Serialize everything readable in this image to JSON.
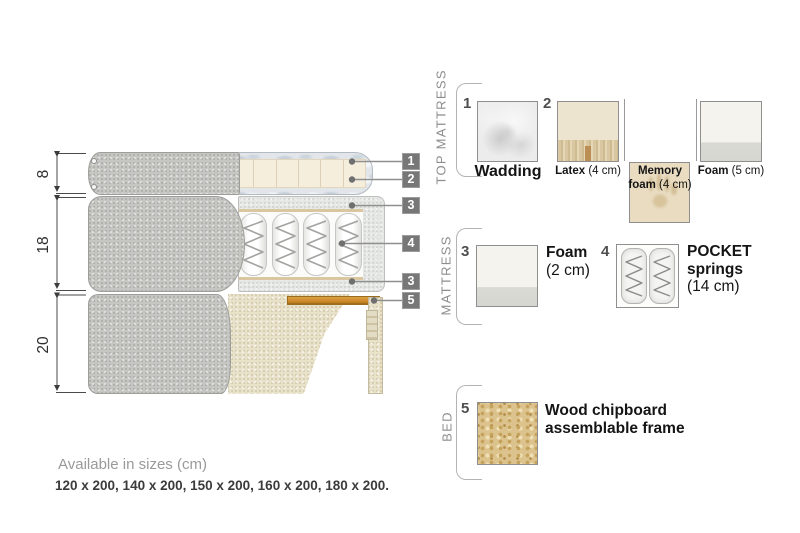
{
  "diagram": {
    "dimension_labels": {
      "top": "8",
      "middle": "18",
      "bottom": "20"
    },
    "callouts": {
      "c1": "1",
      "c2": "2",
      "c3_top": "3",
      "c4": "4",
      "c3_bottom": "3",
      "c5": "5"
    }
  },
  "legend": {
    "top_mattress": {
      "title": "TOP MATTRESS",
      "item1_num": "1",
      "wadding_label": "Wadding",
      "item2_num": "2",
      "latex_name": "Latex",
      "latex_size": " (4 cm)",
      "memory_name_line1": "Memory",
      "memory_name_line2": "foam",
      "memory_size": " (4 cm)",
      "foam_name": "Foam",
      "foam_size": " (5 cm)"
    },
    "mattress": {
      "title": "MATTRESS",
      "item3_num": "3",
      "foam_name": "Foam",
      "foam_size": "(2 cm)",
      "item4_num": "4",
      "springs_name_line1": "POCKET",
      "springs_name_line2": "springs",
      "springs_size": "(14 cm)"
    },
    "bed": {
      "title": "BED",
      "item5_num": "5",
      "frame_line1": "Wood chipboard",
      "frame_line2": "assemblable frame"
    }
  },
  "footer": {
    "sizes_title": "Available in sizes (cm)",
    "sizes_list": "120 x 200, 140 x 200, 150 x 200, 160 x 200, 180 x 200."
  },
  "colors": {
    "fabric_gray": "#c6c7c3",
    "fabric_beige": "#e9e2cb",
    "foam_cream": "#f6eedd",
    "wadding_blue_gray": "#e2e6ea",
    "foam_light": "#e5e7e5",
    "wood_slat": "#c98c2f",
    "chipboard": "#dcc28c",
    "callout_gray": "#777777",
    "line_gray": "#8f8f8f",
    "text_dark": "#1d1d1d",
    "text_gray": "#8d8d8d"
  }
}
